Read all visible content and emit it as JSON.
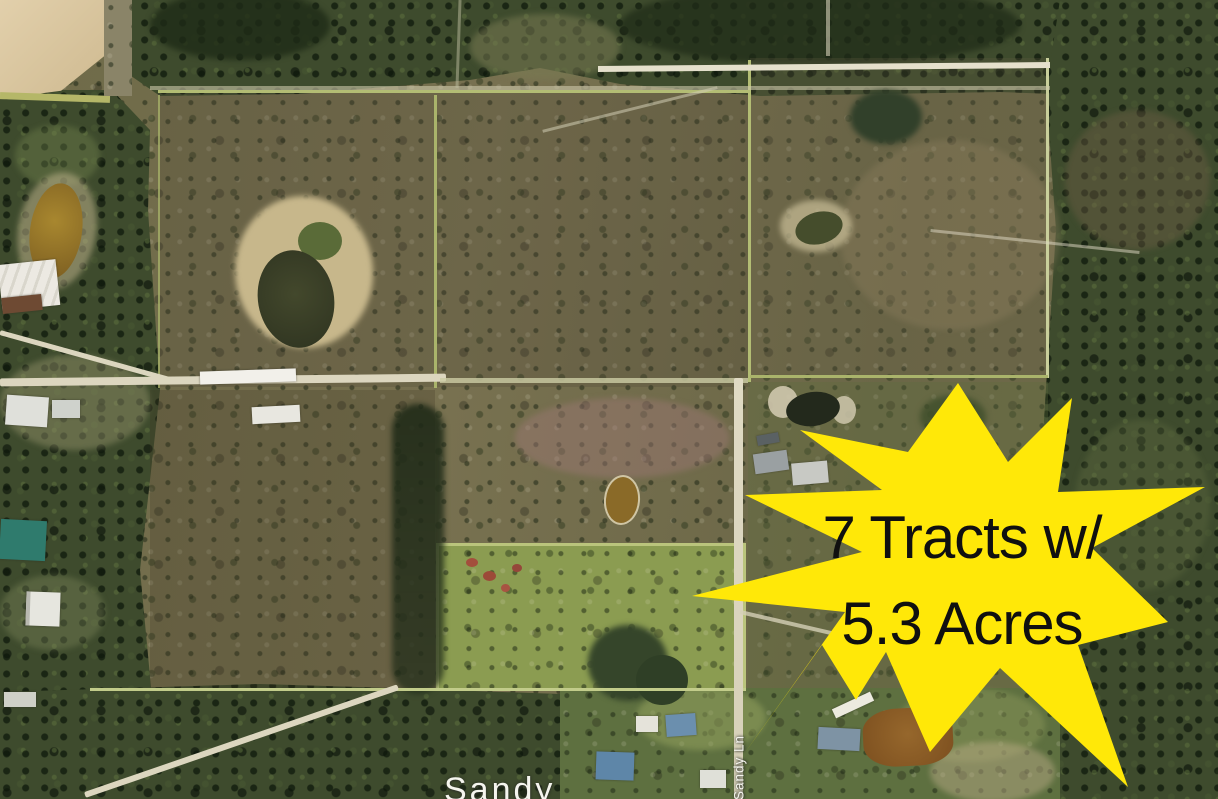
{
  "callout": {
    "line1": "7 Tracts w/",
    "line2": "5.3 Acres",
    "fill": "#FFE808",
    "text_color": "#101010"
  },
  "map": {
    "road_label_vertical": "Sandy Ln",
    "road_label_bottom": "Sandy",
    "colors": {
      "scrub_base": "#6F6A48",
      "forest_dark": "#3E4B2D",
      "grass_parcel": "#8B9C51",
      "dirt_road": "#DCD6BF",
      "boundary_line": "#B3BD74",
      "tan_field": "#D7C29C",
      "pond_brown": "#93702C",
      "pond_dark": "#3A432A",
      "teal_roof": "#2F7B6D",
      "blue_roof": "#5E86A8"
    }
  }
}
